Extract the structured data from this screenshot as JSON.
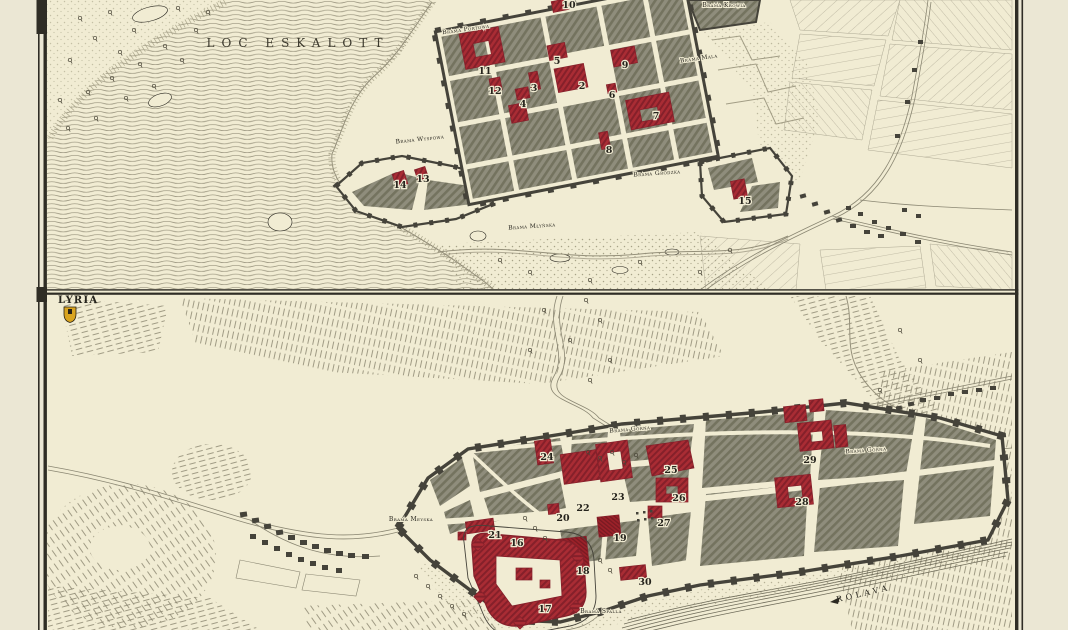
{
  "map": {
    "colors": {
      "paper": "#f1ecd3",
      "margin": "#ebe7d4",
      "frame": "#2f2d25",
      "ink": "#26241d",
      "water_line": "#95907a",
      "block_base": "#8f8d7c",
      "block_line": "#74735f",
      "wall": "#45433a",
      "red": "#a92c34",
      "red_dark": "#85202a",
      "red_deep": "#9c2129",
      "red_deep_line": "#781a22",
      "field_line": "#ada893",
      "stipple": "#a7a287",
      "hachure": "#8b8670",
      "road": "#8a8672",
      "tree": "#4a4638",
      "halo": "#f1ecd3",
      "gold": "#d9a41f"
    },
    "panels": [
      {
        "name": "upper-town-plan",
        "water_label": {
          "text": "LOC ESKALOTT",
          "x": 298,
          "y": 47
        },
        "gates": [
          {
            "text": "Brama Portowa",
            "x": 466,
            "y": 31,
            "rot": -8
          },
          {
            "text": "Brama Krowia",
            "x": 724,
            "y": 7,
            "rot": 0
          },
          {
            "text": "Brama Mala",
            "x": 699,
            "y": 60,
            "rot": -8
          },
          {
            "text": "Brama Wyspowa",
            "x": 420,
            "y": 141,
            "rot": -6
          },
          {
            "text": "Brama Grodzka",
            "x": 657,
            "y": 175,
            "rot": -4
          },
          {
            "text": "Brama Młyńska",
            "x": 532,
            "y": 228,
            "rot": -4
          }
        ],
        "numbers": [
          {
            "n": "10",
            "x": 569,
            "y": 8
          },
          {
            "n": "5",
            "x": 557,
            "y": 64
          },
          {
            "n": "9",
            "x": 625,
            "y": 68
          },
          {
            "n": "11",
            "x": 485,
            "y": 74
          },
          {
            "n": "2",
            "x": 582,
            "y": 89
          },
          {
            "n": "3",
            "x": 534,
            "y": 91
          },
          {
            "n": "12",
            "x": 495,
            "y": 94
          },
          {
            "n": "6",
            "x": 612,
            "y": 98
          },
          {
            "n": "4",
            "x": 523,
            "y": 107
          },
          {
            "n": "7",
            "x": 656,
            "y": 119
          },
          {
            "n": "8",
            "x": 609,
            "y": 153
          },
          {
            "n": "13",
            "x": 423,
            "y": 182
          },
          {
            "n": "14",
            "x": 400,
            "y": 188
          },
          {
            "n": "15",
            "x": 745,
            "y": 204
          }
        ]
      },
      {
        "name": "lower-town-plan",
        "region_label": {
          "text": "LYRIA",
          "x": 58,
          "y": 303
        },
        "river_label": {
          "text": "ROLAVA",
          "x": 864,
          "y": 596,
          "rot": -13
        },
        "gates": [
          {
            "text": "Brama Górna",
            "x": 630,
            "y": 431,
            "rot": -5
          },
          {
            "text": "Brama Górna",
            "x": 866,
            "y": 452,
            "rot": -4
          },
          {
            "text": "Brama Meyska",
            "x": 411,
            "y": 521,
            "rot": 0
          },
          {
            "text": "Brama Spalla",
            "x": 601,
            "y": 613,
            "rot": 0
          }
        ],
        "numbers": [
          {
            "n": "24",
            "x": 547,
            "y": 460
          },
          {
            "n": "29",
            "x": 810,
            "y": 463
          },
          {
            "n": "25",
            "x": 671,
            "y": 473
          },
          {
            "n": "23",
            "x": 618,
            "y": 500
          },
          {
            "n": "26",
            "x": 679,
            "y": 501
          },
          {
            "n": "28",
            "x": 802,
            "y": 505
          },
          {
            "n": "22",
            "x": 583,
            "y": 511
          },
          {
            "n": "20",
            "x": 563,
            "y": 521
          },
          {
            "n": "27",
            "x": 664,
            "y": 526
          },
          {
            "n": "21",
            "x": 495,
            "y": 538
          },
          {
            "n": "19",
            "x": 620,
            "y": 541
          },
          {
            "n": "16",
            "x": 517,
            "y": 546
          },
          {
            "n": "18",
            "x": 583,
            "y": 574
          },
          {
            "n": "30",
            "x": 645,
            "y": 585
          },
          {
            "n": "17",
            "x": 545,
            "y": 612
          }
        ]
      }
    ]
  }
}
